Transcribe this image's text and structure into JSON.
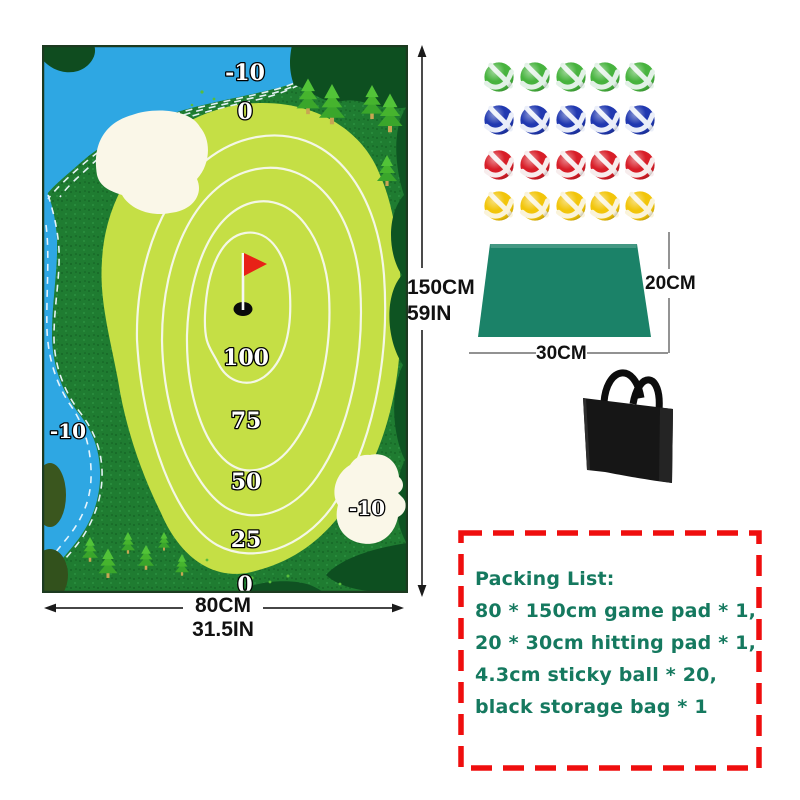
{
  "game_mat": {
    "labels": {
      "top_water": "-10",
      "upper_rough": "0",
      "ring_100": "100",
      "ring_75": "75",
      "ring_50": "50",
      "ring_25": "25",
      "bottom_rough": "0",
      "left_water": "-10",
      "right_bunker": "-10"
    },
    "colors": {
      "water": "#2ea7e3",
      "rough": "#1f7c31",
      "green": "#c5df45",
      "bunker": "#faf7e8",
      "flag": "#e82117",
      "contour": "#f4f7e6"
    }
  },
  "dimensions": {
    "mat_height_cm": "150CM",
    "mat_height_in": "59IN",
    "mat_width_cm": "80CM",
    "mat_width_in": "31.5IN",
    "pad_height_cm": "20CM",
    "pad_width_cm": "30CM"
  },
  "balls": {
    "per_row": 5,
    "rows": [
      {
        "name": "green",
        "color": "#47b33e",
        "band": "#e2f1e6"
      },
      {
        "name": "blue",
        "color": "#2038b0",
        "band": "#eaeef9"
      },
      {
        "name": "red",
        "color": "#d81e28",
        "band": "#f7ecec"
      },
      {
        "name": "yellow",
        "color": "#f2c50a",
        "band": "#faf3d9"
      }
    ]
  },
  "hitting_pad": {
    "color": "#1b8268"
  },
  "storage_bag": {
    "color": "#161616"
  },
  "packing_list": {
    "title": "Packing List:",
    "items": [
      "80 * 150cm game pad * 1,",
      "20 * 30cm hitting pad * 1,",
      "4.3cm sticky ball * 20,",
      "black storage bag * 1"
    ],
    "text_color": "#15795f",
    "border_color": "#ef0e0e"
  }
}
